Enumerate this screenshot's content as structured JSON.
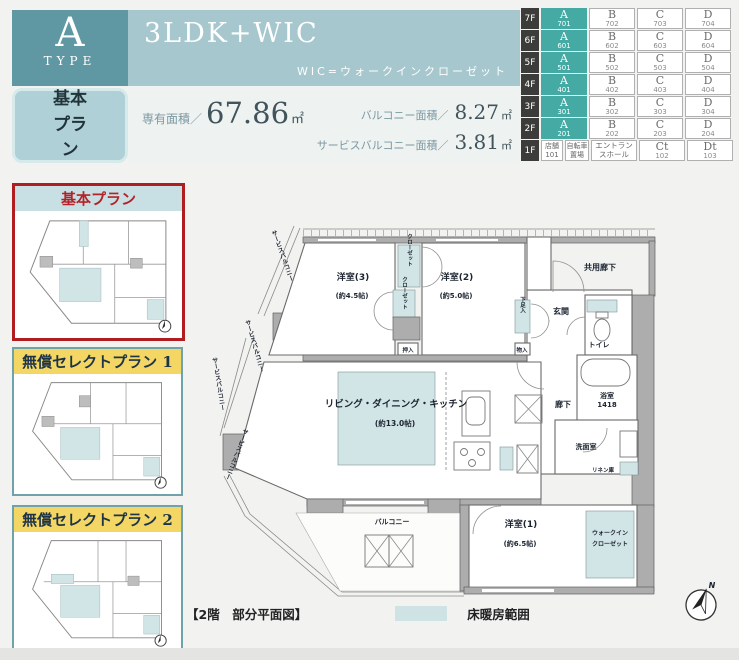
{
  "header": {
    "type_letter": "A",
    "type_word": "TYPE",
    "plan_badge": "基本プラン",
    "layout_title": "3LDK+WIC",
    "wic_note": "WIC=ウォークインクローゼット",
    "area_label": "専有面積／",
    "area_value": "67.86",
    "area_unit": "㎡",
    "balcony_label": "バルコニー面積／",
    "balcony_value": "8.27",
    "balcony_unit": "㎡",
    "service_balcony_label": "サービスバルコニー面積／",
    "service_balcony_value": "3.81",
    "service_balcony_unit": "㎡"
  },
  "floor_table": {
    "rows": [
      {
        "floor": "7F",
        "units": [
          {
            "l": "A",
            "n": "701"
          },
          {
            "l": "B",
            "n": "702"
          },
          {
            "l": "C",
            "n": "703"
          },
          {
            "l": "D",
            "n": "704"
          }
        ]
      },
      {
        "floor": "6F",
        "units": [
          {
            "l": "A",
            "n": "601"
          },
          {
            "l": "B",
            "n": "602"
          },
          {
            "l": "C",
            "n": "603"
          },
          {
            "l": "D",
            "n": "604"
          }
        ]
      },
      {
        "floor": "5F",
        "units": [
          {
            "l": "A",
            "n": "501"
          },
          {
            "l": "B",
            "n": "502"
          },
          {
            "l": "C",
            "n": "503"
          },
          {
            "l": "D",
            "n": "504"
          }
        ]
      },
      {
        "floor": "4F",
        "units": [
          {
            "l": "A",
            "n": "401"
          },
          {
            "l": "B",
            "n": "402"
          },
          {
            "l": "C",
            "n": "403"
          },
          {
            "l": "D",
            "n": "404"
          }
        ]
      },
      {
        "floor": "3F",
        "units": [
          {
            "l": "A",
            "n": "301"
          },
          {
            "l": "B",
            "n": "302"
          },
          {
            "l": "C",
            "n": "303"
          },
          {
            "l": "D",
            "n": "304"
          }
        ]
      },
      {
        "floor": "2F",
        "units": [
          {
            "l": "A",
            "n": "201"
          },
          {
            "l": "B",
            "n": "202"
          },
          {
            "l": "C",
            "n": "203"
          },
          {
            "l": "D",
            "n": "204"
          }
        ]
      }
    ],
    "first_floor": {
      "floor": "1F",
      "shop_label": "店舗",
      "shop_num": "101",
      "bicycle": "自転車置場",
      "entrance": "エントランスホール",
      "ct_label": "Ct",
      "ct_num": "102",
      "dt_label": "Dt",
      "dt_num": "103"
    }
  },
  "sidebar": {
    "plans": [
      {
        "title": "基本プラン"
      },
      {
        "title": "無償セレクトプラン 1"
      },
      {
        "title": "無償セレクトプラン 2"
      }
    ]
  },
  "floorplan": {
    "rooms": {
      "western3": "洋室(3)",
      "western3_size": "(約4.5帖)",
      "western2": "洋室(2)",
      "western2_size": "(約5.0帖)",
      "western1": "洋室(1)",
      "western1_size": "(約6.5帖)",
      "ldk": "リビング・ダイニング・キッチン",
      "ldk_size": "(約13.0帖)",
      "balcony": "バルコニー",
      "service_balcony": "サービスバルコニー",
      "entrance": "玄関",
      "toilet": "トイレ",
      "bath": "浴室",
      "bath_size": "1418",
      "washroom": "洗面室",
      "linen": "リネン庫",
      "hallway": "廊下",
      "common_corridor": "共用廊下",
      "closet": "クローゼット",
      "oshiire": "押入",
      "monoire": "物入",
      "shoebox": "下足入",
      "wic_line1": "ウォークイン",
      "wic_line2": "クローゼット"
    },
    "compass_n": "N"
  },
  "legend": {
    "caption": "【2階　部分平面図】",
    "heating_label": "床暖房範囲"
  },
  "colors": {
    "accent_teal": "#5f97a2",
    "banner_teal": "#a6c7cd",
    "unit_a_teal": "#45a9a4",
    "heating_teal": "#d2e5e6",
    "active_border_red": "#b01c20",
    "select_yellow": "#f3d664"
  }
}
